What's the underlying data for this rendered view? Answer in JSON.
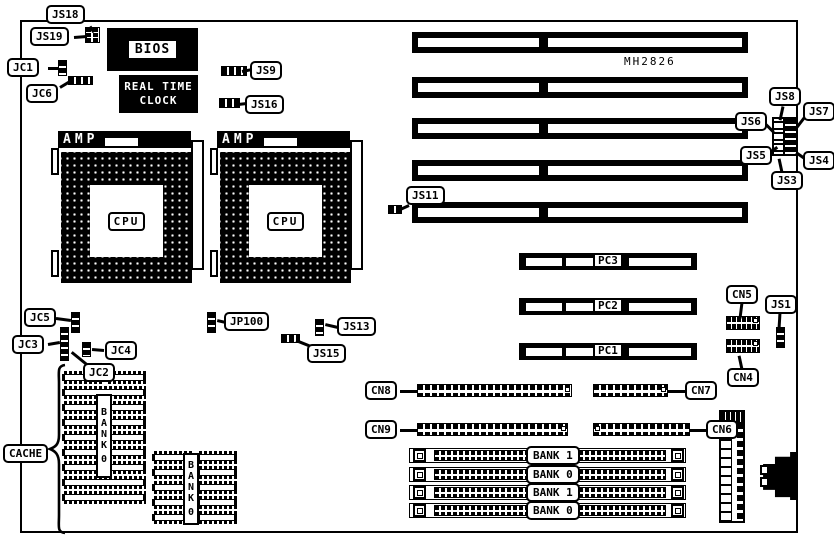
{
  "board": {
    "model": "MH2826",
    "outline": {
      "x": 20,
      "y": 20,
      "w": 778,
      "h": 513
    }
  },
  "texts": {
    "bios": "BIOS",
    "rtc_line1": "REAL TIME",
    "rtc_line2": "CLOCK",
    "amp": "AMP",
    "cpu": "CPU"
  },
  "callouts": [
    {
      "text": "JS18",
      "x": 46,
      "y": 5,
      "line": [
        90,
        25,
        94,
        31
      ]
    },
    {
      "text": "JS19",
      "x": 30,
      "y": 27,
      "line": [
        74,
        36,
        87,
        35
      ]
    },
    {
      "text": "JC1",
      "x": 7,
      "y": 58,
      "line": [
        48,
        67,
        59,
        67
      ]
    },
    {
      "text": "JC6",
      "x": 26,
      "y": 84,
      "line": [
        60,
        86,
        70,
        80
      ]
    },
    {
      "text": "JS9",
      "x": 250,
      "y": 61,
      "line": [
        242,
        70,
        252,
        68
      ]
    },
    {
      "text": "JS16",
      "x": 245,
      "y": 95,
      "line": [
        238,
        103,
        247,
        102
      ]
    },
    {
      "text": "JS8",
      "x": 769,
      "y": 87,
      "line": [
        783,
        105,
        780,
        119
      ]
    },
    {
      "text": "JS7",
      "x": 803,
      "y": 102,
      "line": [
        806,
        114,
        796,
        127
      ]
    },
    {
      "text": "JS6",
      "x": 735,
      "y": 112,
      "line": [
        766,
        123,
        774,
        131
      ]
    },
    {
      "text": "JS5",
      "x": 740,
      "y": 146,
      "line": [
        770,
        151,
        777,
        146
      ]
    },
    {
      "text": "JS4",
      "x": 803,
      "y": 151,
      "line": [
        806,
        158,
        796,
        151
      ]
    },
    {
      "text": "JS3",
      "x": 771,
      "y": 171,
      "line": [
        782,
        171,
        779,
        157
      ]
    },
    {
      "text": "JS11",
      "x": 406,
      "y": 186,
      "line": [
        409,
        204,
        398,
        209
      ]
    },
    {
      "text": "JP100",
      "x": 224,
      "y": 312,
      "line": [
        226,
        321,
        217,
        319
      ]
    },
    {
      "text": "JS13",
      "x": 337,
      "y": 317,
      "line": [
        338,
        326,
        325,
        323
      ]
    },
    {
      "text": "JS15",
      "x": 307,
      "y": 344,
      "line": [
        311,
        345,
        296,
        339
      ]
    },
    {
      "text": "JC5",
      "x": 24,
      "y": 308,
      "line": [
        56,
        317,
        71,
        319
      ]
    },
    {
      "text": "JC3",
      "x": 12,
      "y": 335,
      "line": [
        48,
        343,
        60,
        341
      ]
    },
    {
      "text": "JC4",
      "x": 105,
      "y": 341,
      "line": [
        104,
        349,
        92,
        348
      ]
    },
    {
      "text": "JC2",
      "x": 83,
      "y": 363,
      "line": [
        88,
        364,
        72,
        351
      ]
    },
    {
      "text": "CACHE",
      "x": 3,
      "y": 444
    },
    {
      "text": "CN5",
      "x": 726,
      "y": 285,
      "line": [
        742,
        301,
        740,
        317
      ]
    },
    {
      "text": "JS1",
      "x": 765,
      "y": 295,
      "line": [
        780,
        311,
        779,
        328
      ]
    },
    {
      "text": "CN4",
      "x": 727,
      "y": 368,
      "line": [
        742,
        368,
        739,
        354
      ]
    },
    {
      "text": "CN8",
      "x": 365,
      "y": 381,
      "line": [
        400,
        390,
        418,
        390
      ]
    },
    {
      "text": "CN9",
      "x": 365,
      "y": 420,
      "line": [
        400,
        429,
        418,
        429
      ]
    },
    {
      "text": "CN7",
      "x": 685,
      "y": 381,
      "line": [
        686,
        390,
        667,
        390
      ]
    },
    {
      "text": "CN6",
      "x": 706,
      "y": 420,
      "line": [
        707,
        429,
        689,
        429
      ]
    }
  ],
  "jumpers": [
    {
      "id": "js18-js19-header",
      "x": 85,
      "y": 27,
      "w": 15,
      "h": 16,
      "kind": "grid"
    },
    {
      "id": "jc1-jumper",
      "x": 58,
      "y": 60,
      "w": 9,
      "h": 16,
      "kind": "v"
    },
    {
      "id": "jc6-jumper",
      "x": 68,
      "y": 76,
      "w": 25,
      "h": 9,
      "kind": "h"
    },
    {
      "id": "js9-jumper",
      "x": 221,
      "y": 66,
      "w": 26,
      "h": 10,
      "kind": "h"
    },
    {
      "id": "js16-jumper",
      "x": 219,
      "y": 98,
      "w": 21,
      "h": 10,
      "kind": "h"
    },
    {
      "id": "js11-jumper",
      "x": 388,
      "y": 205,
      "w": 14,
      "h": 9,
      "kind": "h"
    },
    {
      "id": "jp100-jumper",
      "x": 207,
      "y": 312,
      "w": 9,
      "h": 21,
      "kind": "v"
    },
    {
      "id": "js13-jumper",
      "x": 315,
      "y": 319,
      "w": 9,
      "h": 17,
      "kind": "v"
    },
    {
      "id": "js15-jumper",
      "x": 281,
      "y": 334,
      "w": 19,
      "h": 9,
      "kind": "h"
    },
    {
      "id": "jc5-jumper",
      "x": 71,
      "y": 312,
      "w": 9,
      "h": 21,
      "kind": "v"
    },
    {
      "id": "jc3-jumper",
      "x": 60,
      "y": 327,
      "w": 9,
      "h": 34,
      "kind": "v"
    },
    {
      "id": "jc4-jumper",
      "x": 82,
      "y": 342,
      "w": 9,
      "h": 15,
      "kind": "v"
    },
    {
      "id": "js1-jumper",
      "x": 776,
      "y": 327,
      "w": 9,
      "h": 21,
      "kind": "v"
    },
    {
      "id": "js3-js8-block",
      "x": 772,
      "y": 117,
      "w": 26,
      "h": 39,
      "kind": "block"
    }
  ],
  "grid_connectors": [
    {
      "id": "cn5-connector",
      "x": 726,
      "y": 316,
      "w": 34,
      "h": 14
    },
    {
      "id": "cn4-connector",
      "x": 726,
      "y": 339,
      "w": 34,
      "h": 14
    }
  ],
  "stripe_connectors": [
    {
      "id": "cn8-connector",
      "x": 417,
      "y": 384,
      "w": 155,
      "h": 13,
      "sq": "right"
    },
    {
      "id": "cn9-connector",
      "x": 417,
      "y": 423,
      "w": 151,
      "h": 13,
      "sq": "right"
    },
    {
      "id": "cn7-connector",
      "x": 593,
      "y": 384,
      "w": 75,
      "h": 13,
      "sq": "right"
    },
    {
      "id": "cn6-connector",
      "x": 593,
      "y": 423,
      "w": 97,
      "h": 13,
      "sq": "left"
    }
  ],
  "isa": {
    "x": 412,
    "w": 336,
    "h": 21,
    "ys": [
      32,
      77,
      118,
      160,
      202
    ]
  },
  "pci_slots": [
    {
      "label": "PC3",
      "x": 519,
      "y": 253
    },
    {
      "label": "PC2",
      "x": 519,
      "y": 298
    },
    {
      "label": "PC1",
      "x": 519,
      "y": 343
    }
  ],
  "simm_slots": [
    {
      "label": "BANK 1",
      "y": 448
    },
    {
      "label": "BANK 0",
      "y": 467
    },
    {
      "label": "BANK 1",
      "y": 485
    },
    {
      "label": "BANK 0",
      "y": 503
    }
  ],
  "cpu_sockets": [
    {
      "x": 58,
      "y": 131
    },
    {
      "x": 217,
      "y": 131
    }
  ],
  "cache_banks": [
    {
      "label": "BANK 0",
      "x": 62,
      "y": 371,
      "w": 84,
      "rows": 9,
      "wide_rows": [
        1,
        7,
        8
      ],
      "label_x": 96,
      "label_y": 394,
      "label_h": 84
    },
    {
      "label": "BANK 0",
      "x": 152,
      "y": 451,
      "w": 85,
      "rows": 5,
      "wide_rows": [],
      "label_x": 183,
      "label_y": 453,
      "label_h": 72
    }
  ]
}
